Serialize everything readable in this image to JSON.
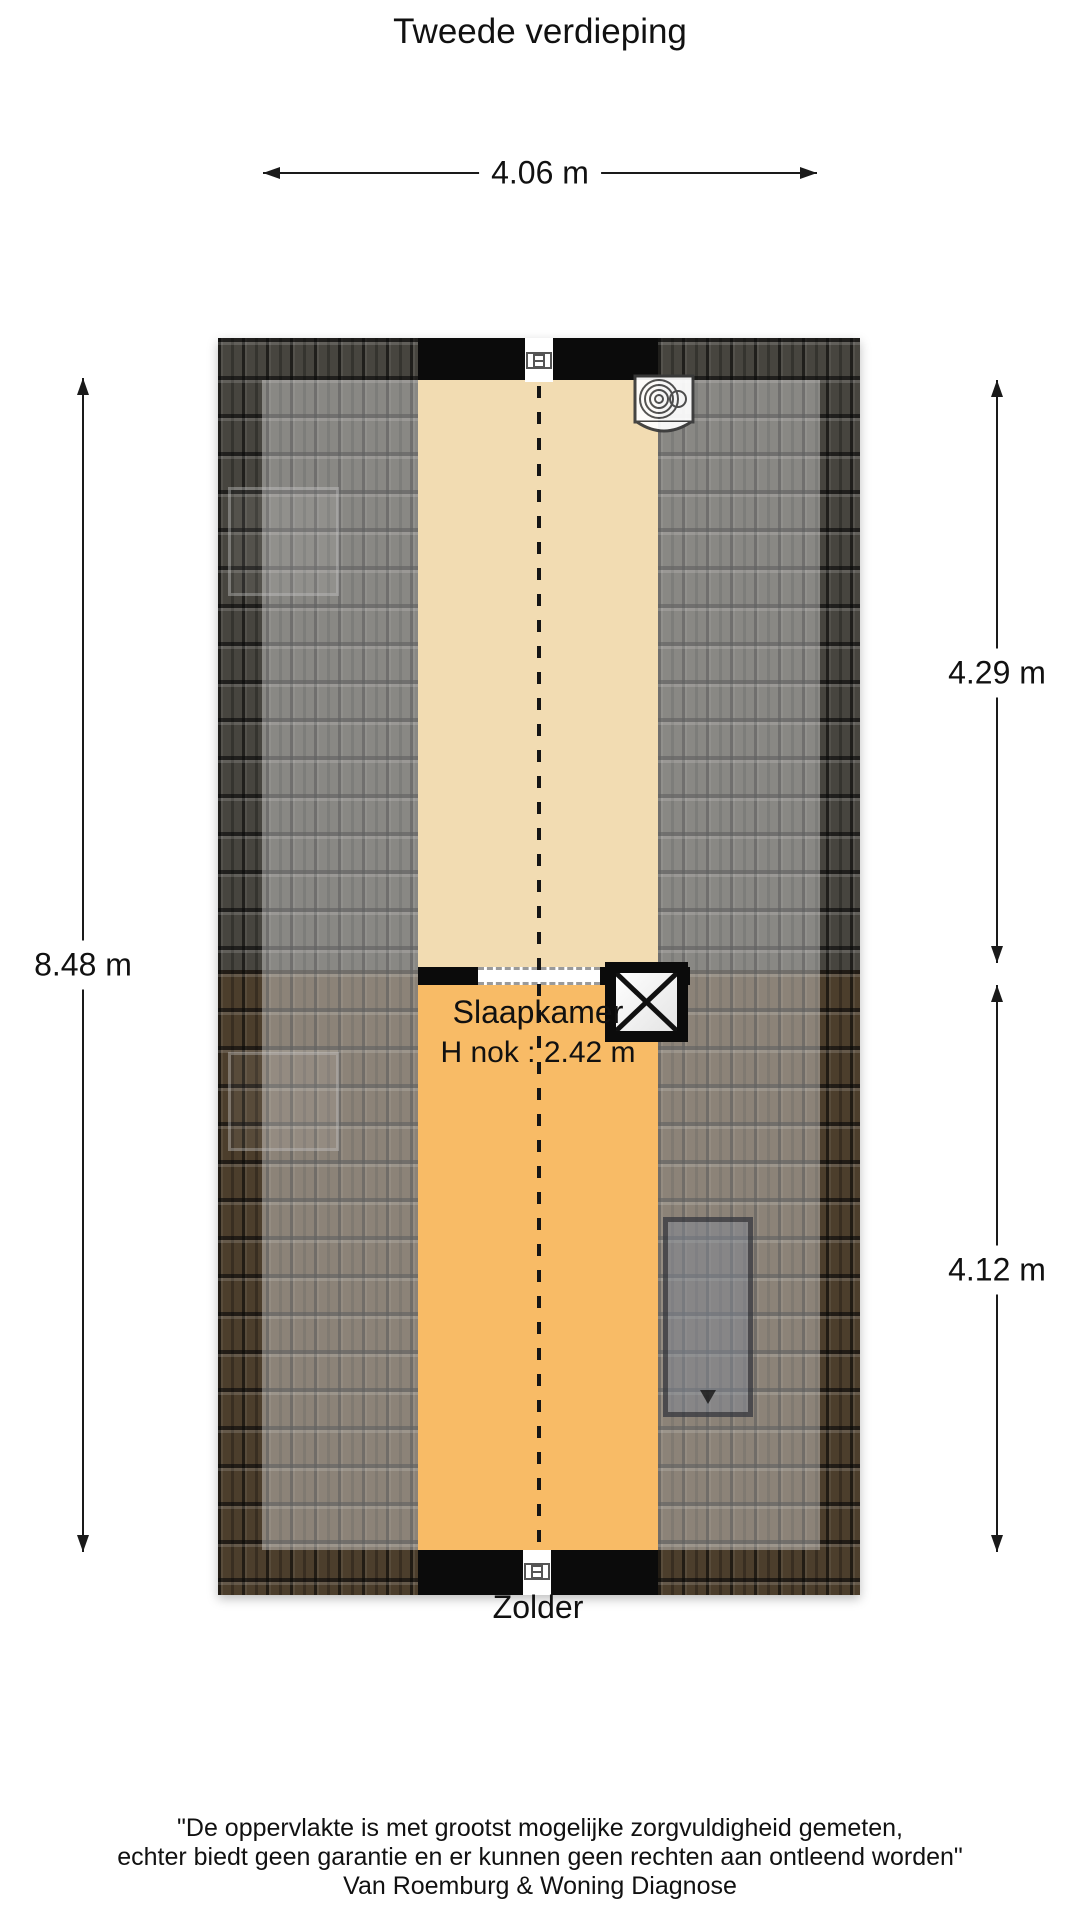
{
  "title": "Tweede verdieping",
  "dimensions": {
    "top_width": "4.06 m",
    "left_height": "8.48 m",
    "right_upper": "4.29 m",
    "right_lower": "4.12 m"
  },
  "rooms": {
    "slaapkamer": {
      "name": "Slaapkamer",
      "ridge_height": "H nok : 2.42 m"
    },
    "zolder": {
      "name": "Zolder"
    }
  },
  "features": {
    "washing_machine": "washing-machine top-right of Slaapkamer",
    "stairwell_void": "crossed-out stair opening at middle right",
    "roof_window": "skylight on lower-right roof section",
    "ridge_line": "dashed nok ridge line through both rooms"
  },
  "colors": {
    "floor_slaapkamer": "#f2dcb2",
    "floor_zolder": "#f8bb66",
    "roof_gray": "#47453f",
    "roof_brown": "#4c3e2c",
    "wall": "#0b0b0b",
    "background": "#ffffff"
  },
  "disclaimer": {
    "line1": "\"De oppervlakte is met grootst mogelijke zorgvuldigheid gemeten,",
    "line2": "echter biedt geen garantie en er kunnen geen rechten aan ontleend worden\"",
    "line3": "Van Roemburg & Woning Diagnose"
  }
}
